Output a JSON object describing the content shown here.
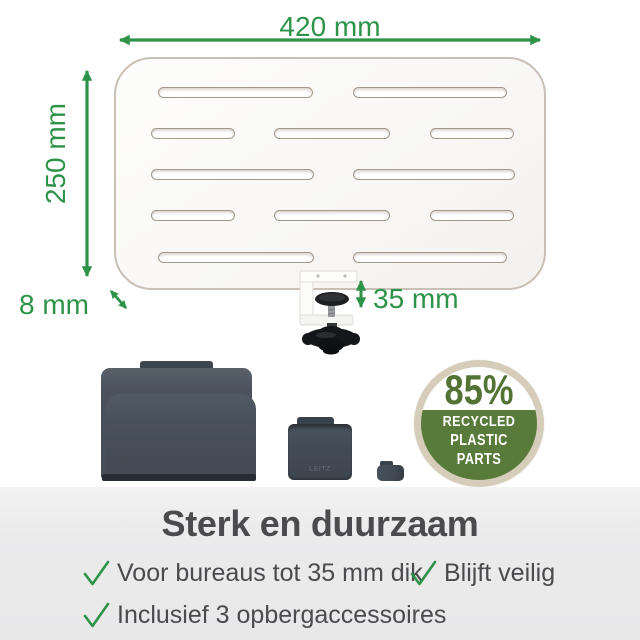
{
  "product": {
    "brand": "LEITZ",
    "dimensions": {
      "width": "420 mm",
      "height": "250 mm",
      "thickness": "8 mm",
      "clamp_capacity": "35 mm"
    }
  },
  "badge": {
    "percent": "85%",
    "line1": "RECYCLED",
    "line2": "PLASTIC PARTS"
  },
  "footer": {
    "title": "Sterk en duurzaam",
    "bullets": [
      "Voor bureaus tot 35 mm dik",
      "Blijft veilig",
      "Inclusief 3 opbergaccessoires"
    ]
  },
  "colors": {
    "accent_green": "#2D9348",
    "badge_ring_beige": "#D5CDBA",
    "badge_green": "#587B3B",
    "badge_percent_green": "#527334",
    "text_dark_gray": "#4B4B4E",
    "accessory_slate": "#464F59",
    "panel_edge_tan": "#C9C0B5",
    "footer_background": "#E9E9EA"
  }
}
